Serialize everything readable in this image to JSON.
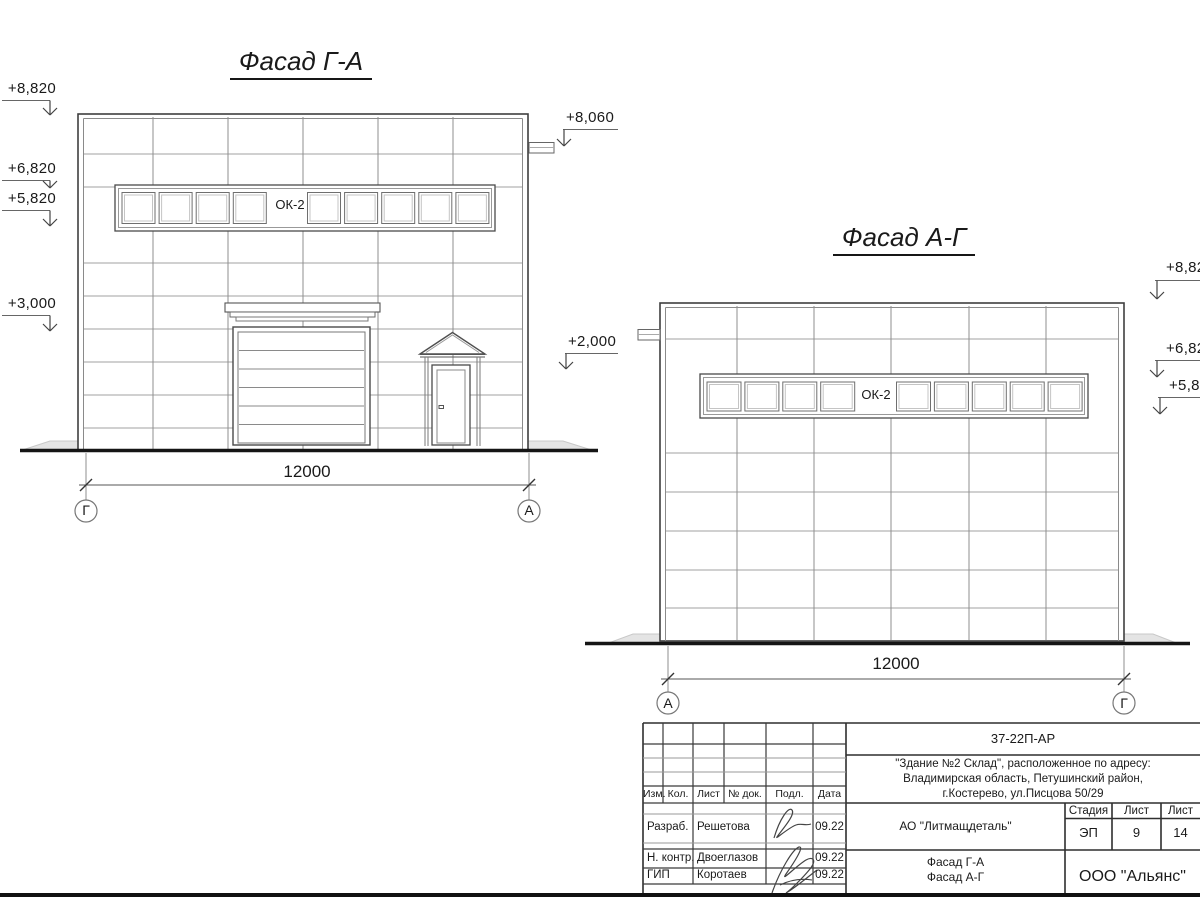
{
  "style": {
    "paper": "#ffffff",
    "ink": "#1a1a1a",
    "outline_color": "#3f3f3f",
    "panel_line_color": "#9f9f9f",
    "ground_color": "#151515",
    "blind_area_fill": "#e4e4e4"
  },
  "facade_ga": {
    "title": "Фасад Г-А",
    "window_tag": "ОК-2",
    "dimension": "12000",
    "axis_left": "Г",
    "axis_right": "А",
    "elevations_left": [
      "+8,820",
      "+6,820",
      "+5,820",
      "+3,000"
    ],
    "elevations_right": [
      "+8,060",
      "+2,000"
    ]
  },
  "facade_ag": {
    "title": "Фасад А-Г",
    "window_tag": "ОК-2",
    "dimension": "12000",
    "axis_left": "А",
    "axis_right": "Г",
    "elevations_right": [
      "+8,82",
      "+6,82",
      "+5,82"
    ]
  },
  "stamp": {
    "doc_code": "37-22П-АР",
    "object_lines": [
      "\"Здание №2 Склад\", расположенное по адресу:",
      "Владимирская область, Петушинский район,",
      "г.Костерево, ул.Писцова 50/29"
    ],
    "columns": [
      "Изм.",
      "Кол.",
      "Лист",
      "№ док.",
      "Подл.",
      "Дата"
    ],
    "signers": [
      {
        "role": "Разраб.",
        "name": "Решетова",
        "date": "09.22"
      },
      {
        "role": "Н. контр.",
        "name": "Двоеглазов",
        "date": "09.22"
      },
      {
        "role": "ГИП",
        "name": "Коротаев",
        "date": "09.22"
      }
    ],
    "customer": "АО \"Литмащдеталь\"",
    "stage_label": "Стадия",
    "stage_value": "ЭП",
    "sheet_label": "Лист",
    "sheet_value": "9",
    "sheets_label": "Лист",
    "sheets_value": "14",
    "drawing_titles": [
      "Фасад Г-А",
      "Фасад А-Г"
    ],
    "organization": "ООО \"Альянс\""
  }
}
